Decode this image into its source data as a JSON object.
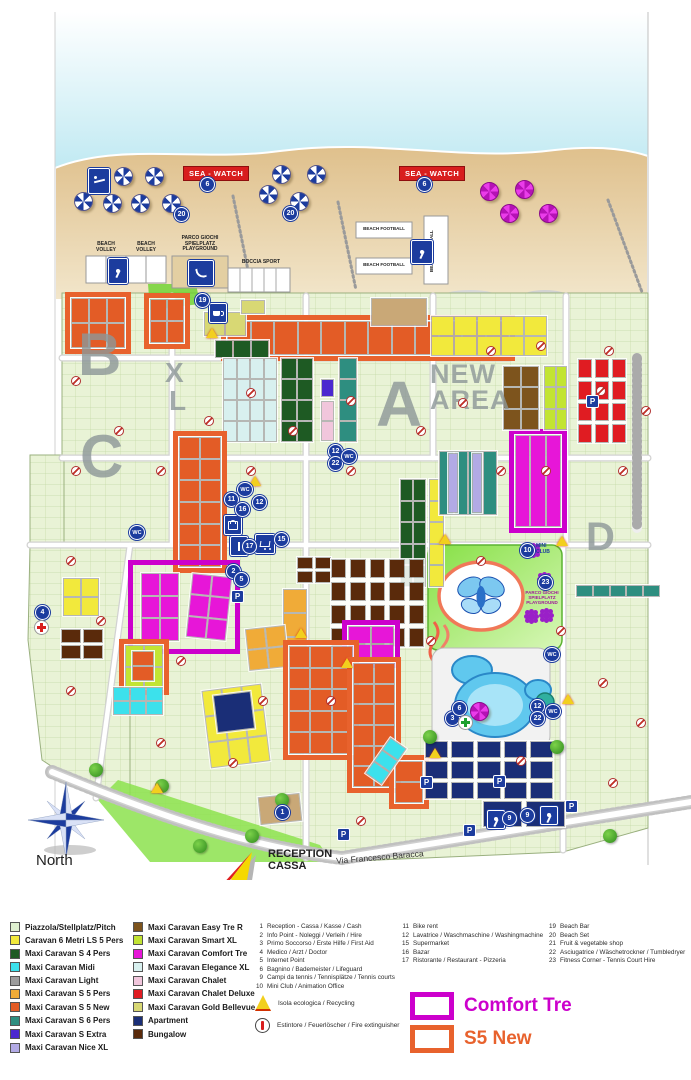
{
  "palette": {
    "pitch": "#e9f3d6",
    "yellow": "#f2e93c",
    "dkgreen": "#1e5a23",
    "cyan": "#3ce1ec",
    "gray": "#9d9d9d",
    "amber": "#f0ab38",
    "s5new": "#e35c26",
    "teal": "#2e8e80",
    "extra": "#4b28cf",
    "nicexl": "#b2aae5",
    "brown": "#7d541d",
    "smart": "#c2e433",
    "comfort": "#e716d8",
    "elegance": "#d8f0ef",
    "chalet": "#f1c6dc",
    "deluxe": "#e01c22",
    "gold": "#d8d874",
    "apt": "#1a2e77",
    "bung": "#5a2a0b",
    "tan": "#c9a877",
    "tennis": "#1a2e77",
    "outlineComfort": "#cc00cc",
    "outlineS5": "#e8622d",
    "badge": "#1c3c9e",
    "seawatch": "#d81e1e"
  },
  "beach": {
    "sea_watch": "SEA - WATCH",
    "beach_volley": "BEACH\nVOLLEY",
    "playground": "PARCO GIOCHI\nSPIELPLATZ\nPLAYGROUND",
    "boccia": "BOCCIA SPORT",
    "beach_football": "BEACH FOOTBALL"
  },
  "map": {
    "texts": {
      "wc": "WC",
      "parking": "P",
      "mini_club": "MINI\nCLUB",
      "playground": "PARCO GIOCHI\nSPIELPLATZ\nPLAYGROUND",
      "reception": "RECEPTION\nCASSA",
      "street": "Via Francesco Baracca",
      "north": "North"
    },
    "area_letters": [
      {
        "t": "B",
        "x": 78,
        "y": 326,
        "s": 60
      },
      {
        "t": "C",
        "x": 80,
        "y": 428,
        "s": 60
      },
      {
        "t": "X",
        "x": 165,
        "y": 360,
        "s": 28
      },
      {
        "t": "L",
        "x": 169,
        "y": 388,
        "s": 28
      },
      {
        "t": "A",
        "x": 376,
        "y": 374,
        "s": 64
      },
      {
        "t": "D",
        "x": 586,
        "y": 518,
        "s": 40
      },
      {
        "t": "NEW\nAREA",
        "x": 430,
        "y": 362,
        "s": 27
      }
    ],
    "badges": [
      {
        "n": "6",
        "x": 207,
        "y": 184
      },
      {
        "n": "6",
        "x": 424,
        "y": 184
      },
      {
        "n": "20",
        "x": 181,
        "y": 214
      },
      {
        "n": "20",
        "x": 290,
        "y": 213
      },
      {
        "n": "19",
        "x": 202,
        "y": 300
      },
      {
        "n": "12",
        "x": 335,
        "y": 451
      },
      {
        "n": "22",
        "x": 335,
        "y": 463
      },
      {
        "n": "11",
        "x": 231,
        "y": 499
      },
      {
        "n": "12",
        "x": 259,
        "y": 502
      },
      {
        "n": "16",
        "x": 242,
        "y": 509
      },
      {
        "n": "17",
        "x": 249,
        "y": 546
      },
      {
        "n": "15",
        "x": 281,
        "y": 539
      },
      {
        "n": "2",
        "x": 233,
        "y": 571
      },
      {
        "n": "5",
        "x": 241,
        "y": 579
      },
      {
        "n": "4",
        "x": 42,
        "y": 612
      },
      {
        "n": "10",
        "x": 527,
        "y": 550
      },
      {
        "n": "23",
        "x": 545,
        "y": 582
      },
      {
        "n": "12",
        "x": 537,
        "y": 706
      },
      {
        "n": "22",
        "x": 537,
        "y": 718
      },
      {
        "n": "3",
        "x": 452,
        "y": 718
      },
      {
        "n": "6",
        "x": 459,
        "y": 708
      },
      {
        "n": "9",
        "x": 509,
        "y": 818
      },
      {
        "n": "9",
        "x": 527,
        "y": 815
      },
      {
        "n": "1",
        "x": 282,
        "y": 812
      }
    ],
    "wc_badges": [
      [
        244,
        489
      ],
      [
        348,
        456
      ],
      [
        551,
        654
      ],
      [
        552,
        711
      ],
      [
        136,
        532
      ]
    ],
    "parking_badges": [
      [
        592,
        401
      ],
      [
        237,
        596
      ],
      [
        426,
        782
      ],
      [
        499,
        781
      ],
      [
        469,
        830
      ],
      [
        571,
        806
      ],
      [
        343,
        834
      ]
    ],
    "umbrellas_blue": [
      [
        122,
        175
      ],
      [
        153,
        175
      ],
      [
        82,
        200
      ],
      [
        111,
        202
      ],
      [
        139,
        202
      ],
      [
        170,
        202
      ],
      [
        280,
        173
      ],
      [
        315,
        173
      ],
      [
        267,
        193
      ],
      [
        298,
        200
      ]
    ],
    "umbrellas_pink": [
      [
        488,
        190
      ],
      [
        523,
        188
      ],
      [
        508,
        212
      ],
      [
        547,
        212
      ],
      [
        478,
        710
      ]
    ],
    "markers": [
      [
        75,
        380
      ],
      [
        75,
        470
      ],
      [
        118,
        430
      ],
      [
        160,
        470
      ],
      [
        208,
        420
      ],
      [
        250,
        392
      ],
      [
        250,
        470
      ],
      [
        292,
        430
      ],
      [
        350,
        400
      ],
      [
        350,
        470
      ],
      [
        420,
        430
      ],
      [
        462,
        402
      ],
      [
        500,
        470
      ],
      [
        545,
        470
      ],
      [
        600,
        390
      ],
      [
        622,
        470
      ],
      [
        70,
        560
      ],
      [
        100,
        620
      ],
      [
        70,
        690
      ],
      [
        180,
        660
      ],
      [
        262,
        700
      ],
      [
        232,
        762
      ],
      [
        330,
        700
      ],
      [
        430,
        640
      ],
      [
        560,
        630
      ],
      [
        602,
        682
      ],
      [
        640,
        722
      ],
      [
        612,
        782
      ],
      [
        520,
        760
      ],
      [
        360,
        820
      ],
      [
        160,
        742
      ],
      [
        480,
        560
      ],
      [
        608,
        350
      ],
      [
        645,
        410
      ],
      [
        540,
        345
      ],
      [
        490,
        350
      ]
    ],
    "recycling_points": [
      [
        212,
        337
      ],
      [
        255,
        485
      ],
      [
        562,
        545
      ],
      [
        445,
        543
      ],
      [
        568,
        703
      ],
      [
        347,
        667
      ],
      [
        157,
        792
      ],
      [
        435,
        757
      ],
      [
        301,
        637
      ]
    ],
    "gears": [
      [
        530,
        547
      ],
      [
        541,
        576
      ],
      [
        528,
        613
      ],
      [
        543,
        612
      ]
    ],
    "trees": [
      [
        162,
        786
      ],
      [
        252,
        836
      ],
      [
        430,
        737
      ],
      [
        557,
        747
      ],
      [
        610,
        836
      ],
      [
        96,
        770
      ],
      [
        282,
        800
      ],
      [
        200,
        846
      ]
    ],
    "clusters": [
      {
        "x": 70,
        "y": 297,
        "w": 56,
        "h": 52,
        "c": "s5new",
        "cols": 3,
        "rows": 2,
        "o": "outlineS5"
      },
      {
        "x": 149,
        "y": 298,
        "w": 36,
        "h": 46,
        "c": "s5new",
        "cols": 2,
        "rows": 2,
        "o": "outlineS5"
      },
      {
        "x": 226,
        "y": 320,
        "w": 284,
        "h": 36,
        "c": "s5new",
        "cols": 12,
        "rows": 1,
        "o": "outlineS5"
      },
      {
        "x": 203,
        "y": 311,
        "w": 44,
        "h": 26,
        "c": "gold",
        "cols": 2,
        "rows": 1
      },
      {
        "x": 214,
        "y": 339,
        "w": 56,
        "h": 20,
        "c": "dkgreen",
        "cols": 3,
        "rows": 1
      },
      {
        "x": 240,
        "y": 299,
        "w": 26,
        "h": 16,
        "c": "gold",
        "cols": 1,
        "rows": 1
      },
      {
        "x": 370,
        "y": 297,
        "w": 58,
        "h": 30,
        "c": "tan",
        "cols": 1,
        "rows": 1
      },
      {
        "x": 430,
        "y": 315,
        "w": 118,
        "h": 42,
        "c": "yellow",
        "cols": 5,
        "rows": 2
      },
      {
        "x": 399,
        "y": 478,
        "w": 28,
        "h": 110,
        "c": "dkgreen",
        "cols": 2,
        "rows": 5
      },
      {
        "x": 428,
        "y": 478,
        "w": 17,
        "h": 110,
        "c": "yellow",
        "cols": 1,
        "rows": 5
      },
      {
        "x": 222,
        "y": 357,
        "w": 56,
        "h": 86,
        "c": "elegance",
        "cols": 4,
        "rows": 4
      },
      {
        "x": 280,
        "y": 357,
        "w": 34,
        "h": 86,
        "c": "dkgreen",
        "cols": 2,
        "rows": 4
      },
      {
        "x": 338,
        "y": 357,
        "w": 20,
        "h": 86,
        "c": "teal",
        "cols": 1,
        "rows": 4
      },
      {
        "x": 320,
        "y": 378,
        "w": 15,
        "h": 20,
        "c": "extra",
        "cols": 1,
        "rows": 1
      },
      {
        "x": 320,
        "y": 400,
        "w": 15,
        "h": 42,
        "c": "chalet",
        "cols": 1,
        "rows": 2
      },
      {
        "x": 438,
        "y": 450,
        "w": 60,
        "h": 66,
        "c": "teal",
        "cols": 4,
        "rows": 1
      },
      {
        "x": 447,
        "y": 452,
        "w": 12,
        "h": 62,
        "c": "nicexl",
        "cols": 1,
        "rows": 1
      },
      {
        "x": 471,
        "y": 452,
        "w": 12,
        "h": 62,
        "c": "nicexl",
        "cols": 1,
        "rows": 1
      },
      {
        "x": 514,
        "y": 434,
        "w": 48,
        "h": 94,
        "c": "comfort",
        "cols": 3,
        "rows": 1,
        "o": "outlineComfort"
      },
      {
        "x": 577,
        "y": 358,
        "w": 50,
        "h": 86,
        "c": "deluxe",
        "cols": 3,
        "rows": 4,
        "g": 5
      },
      {
        "x": 502,
        "y": 365,
        "w": 38,
        "h": 66,
        "c": "brown",
        "cols": 2,
        "rows": 3
      },
      {
        "x": 543,
        "y": 365,
        "w": 25,
        "h": 66,
        "c": "smart",
        "cols": 2,
        "rows": 3
      },
      {
        "x": 575,
        "y": 584,
        "w": 86,
        "h": 14,
        "c": "teal",
        "cols": 5,
        "rows": 1
      },
      {
        "x": 178,
        "y": 436,
        "w": 44,
        "h": 132,
        "c": "s5new",
        "cols": 2,
        "rows": 6,
        "o": "outlineS5"
      },
      {
        "x": 133,
        "y": 565,
        "w": 102,
        "h": 84,
        "c": "",
        "cols": 0,
        "rows": 0,
        "o": "outlineComfort"
      },
      {
        "x": 140,
        "y": 572,
        "w": 40,
        "h": 70,
        "c": "comfort",
        "cols": 2,
        "rows": 3
      },
      {
        "x": 188,
        "y": 574,
        "w": 42,
        "h": 66,
        "c": "comfort",
        "cols": 2,
        "rows": 3,
        "r": 6
      },
      {
        "x": 124,
        "y": 644,
        "w": 40,
        "h": 46,
        "c": "smart",
        "cols": 2,
        "rows": 2,
        "o": "outlineS5"
      },
      {
        "x": 131,
        "y": 650,
        "w": 24,
        "h": 32,
        "c": "s5new",
        "cols": 1,
        "rows": 2
      },
      {
        "x": 296,
        "y": 556,
        "w": 36,
        "h": 28,
        "c": "bung",
        "cols": 2,
        "rows": 2,
        "g": 4
      },
      {
        "x": 330,
        "y": 558,
        "w": 95,
        "h": 90,
        "c": "bung",
        "cols": 5,
        "rows": 4,
        "g": 6
      },
      {
        "x": 60,
        "y": 628,
        "w": 44,
        "h": 32,
        "c": "bung",
        "cols": 2,
        "rows": 2,
        "g": 4
      },
      {
        "x": 347,
        "y": 625,
        "w": 48,
        "h": 38,
        "c": "comfort",
        "cols": 2,
        "rows": 2,
        "o": "outlineComfort"
      },
      {
        "x": 282,
        "y": 588,
        "w": 26,
        "h": 74,
        "c": "amber",
        "cols": 1,
        "rows": 3
      },
      {
        "x": 246,
        "y": 626,
        "w": 42,
        "h": 44,
        "c": "amber",
        "cols": 2,
        "rows": 2,
        "r": -6
      },
      {
        "x": 205,
        "y": 686,
        "w": 62,
        "h": 80,
        "c": "yellow",
        "cols": 3,
        "rows": 3,
        "r": -7
      },
      {
        "x": 62,
        "y": 577,
        "w": 38,
        "h": 40,
        "c": "yellow",
        "cols": 2,
        "rows": 2
      },
      {
        "x": 288,
        "y": 645,
        "w": 66,
        "h": 110,
        "c": "s5new",
        "cols": 3,
        "rows": 5,
        "o": "outlineS5"
      },
      {
        "x": 352,
        "y": 662,
        "w": 44,
        "h": 126,
        "c": "s5new",
        "cols": 2,
        "rows": 6,
        "o": "outlineS5"
      },
      {
        "x": 394,
        "y": 760,
        "w": 30,
        "h": 44,
        "c": "s5new",
        "cols": 1,
        "rows": 2,
        "o": "outlineS5"
      },
      {
        "x": 375,
        "y": 738,
        "w": 22,
        "h": 46,
        "c": "cyan",
        "cols": 1,
        "rows": 3,
        "r": 35
      },
      {
        "x": 424,
        "y": 740,
        "w": 130,
        "h": 60,
        "c": "apt",
        "cols": 5,
        "rows": 3,
        "g": 5
      },
      {
        "x": 482,
        "y": 800,
        "w": 84,
        "h": 28,
        "c": "tennis",
        "cols": 2,
        "rows": 1,
        "g": 6
      },
      {
        "x": 214,
        "y": 692,
        "w": 40,
        "h": 40,
        "c": "tennis",
        "cols": 1,
        "rows": 1,
        "r": -7
      },
      {
        "x": 112,
        "y": 686,
        "w": 52,
        "h": 30,
        "c": "cyan",
        "cols": 3,
        "rows": 2
      },
      {
        "x": 258,
        "y": 794,
        "w": 44,
        "h": 30,
        "c": "tan",
        "cols": 1,
        "rows": 1,
        "r": -6
      }
    ]
  },
  "legend": {
    "pitch_types_col1": [
      {
        "label": "Piazzola/Stellplatz/Pitch",
        "color": "#dff0d0"
      },
      {
        "label": "Caravan 6 Metri LS 5 Pers",
        "color": "#f2e93c"
      },
      {
        "label": "Maxi Caravan S 4 Pers",
        "color": "#1e5a23"
      },
      {
        "label": "Maxi Caravan Midi",
        "color": "#3ce1ec"
      },
      {
        "label": "Maxi Caravan Light",
        "color": "#9d9d9d"
      },
      {
        "label": "Maxi Caravan S 5 Pers",
        "color": "#f0ab38"
      },
      {
        "label": "Maxi Caravan S 5 New",
        "color": "#e35c26"
      },
      {
        "label": "Maxi Caravan S 6 Pers",
        "color": "#2e8e80"
      },
      {
        "label": "Maxi Caravan S Extra",
        "color": "#4b28cf"
      },
      {
        "label": "Maxi Caravan Nice XL",
        "color": "#b2aae5"
      }
    ],
    "pitch_types_col2": [
      {
        "label": "Maxi Caravan Easy Tre R",
        "color": "#7d541d"
      },
      {
        "label": "Maxi Caravan Smart XL",
        "color": "#c2e433"
      },
      {
        "label": "Maxi Caravan Comfort Tre",
        "color": "#e716d8"
      },
      {
        "label": "Maxi Caravan Elegance XL",
        "color": "#d8f0ef"
      },
      {
        "label": "Maxi Caravan Chalet",
        "color": "#f1c6dc"
      },
      {
        "label": "Maxi Caravan Chalet Deluxe",
        "color": "#e01c22"
      },
      {
        "label": "Maxi Caravan Gold Bellevue",
        "color": "#d8d874"
      },
      {
        "label": "Apartment",
        "color": "#1a2e77"
      },
      {
        "label": "Bungalow",
        "color": "#5a2a0b"
      }
    ],
    "services_col1": [
      {
        "n": "1",
        "label": "Reception - Cassa / Kasse / Cash"
      },
      {
        "n": "2",
        "label": "Info Point - Noleggi / Verleih / Hire"
      },
      {
        "n": "3",
        "label": "Primo Soccorso / Erste Hilfe / First Aid"
      },
      {
        "n": "4",
        "label": "Medico / Arzt / Doctor"
      },
      {
        "n": "5",
        "label": "Internet Point"
      },
      {
        "n": "6",
        "label": "Bagnino / Bademeister / Lifeguard"
      },
      {
        "n": "9",
        "label": "Campi da tennis / Tennisplätze / Tennis courts"
      },
      {
        "n": "10",
        "label": "Mini Club / Animation Office"
      }
    ],
    "services_col2": [
      {
        "n": "11",
        "label": "Bike rent"
      },
      {
        "n": "12",
        "label": "Lavatrice / Waschmaschine / Washingmachine"
      },
      {
        "n": "15",
        "label": "Supermarket"
      },
      {
        "n": "16",
        "label": "Bazar"
      },
      {
        "n": "17",
        "label": "Ristorante / Restaurant - Pizzeria"
      }
    ],
    "services_col3": [
      {
        "n": "19",
        "label": "Beach Bar"
      },
      {
        "n": "20",
        "label": "Beach Set"
      },
      {
        "n": "21",
        "label": "Fruit & vegetable shop"
      },
      {
        "n": "22",
        "label": "Asciugatrice / Wäschetrockner / Tumbledryer"
      },
      {
        "n": "23",
        "label": "Fitness Corner - Tennis Court Hire"
      }
    ],
    "notes": [
      {
        "icon": "recycling",
        "label": "Isola ecologica / Recycling"
      },
      {
        "icon": "fire-extinguisher",
        "label": "Estintore / Feuerlöscher / Fire extinguisher"
      }
    ],
    "highlights": [
      {
        "label": "Comfort Tre",
        "color": "#cc00cc"
      },
      {
        "label": "S5 New",
        "color": "#e8622d"
      }
    ]
  }
}
